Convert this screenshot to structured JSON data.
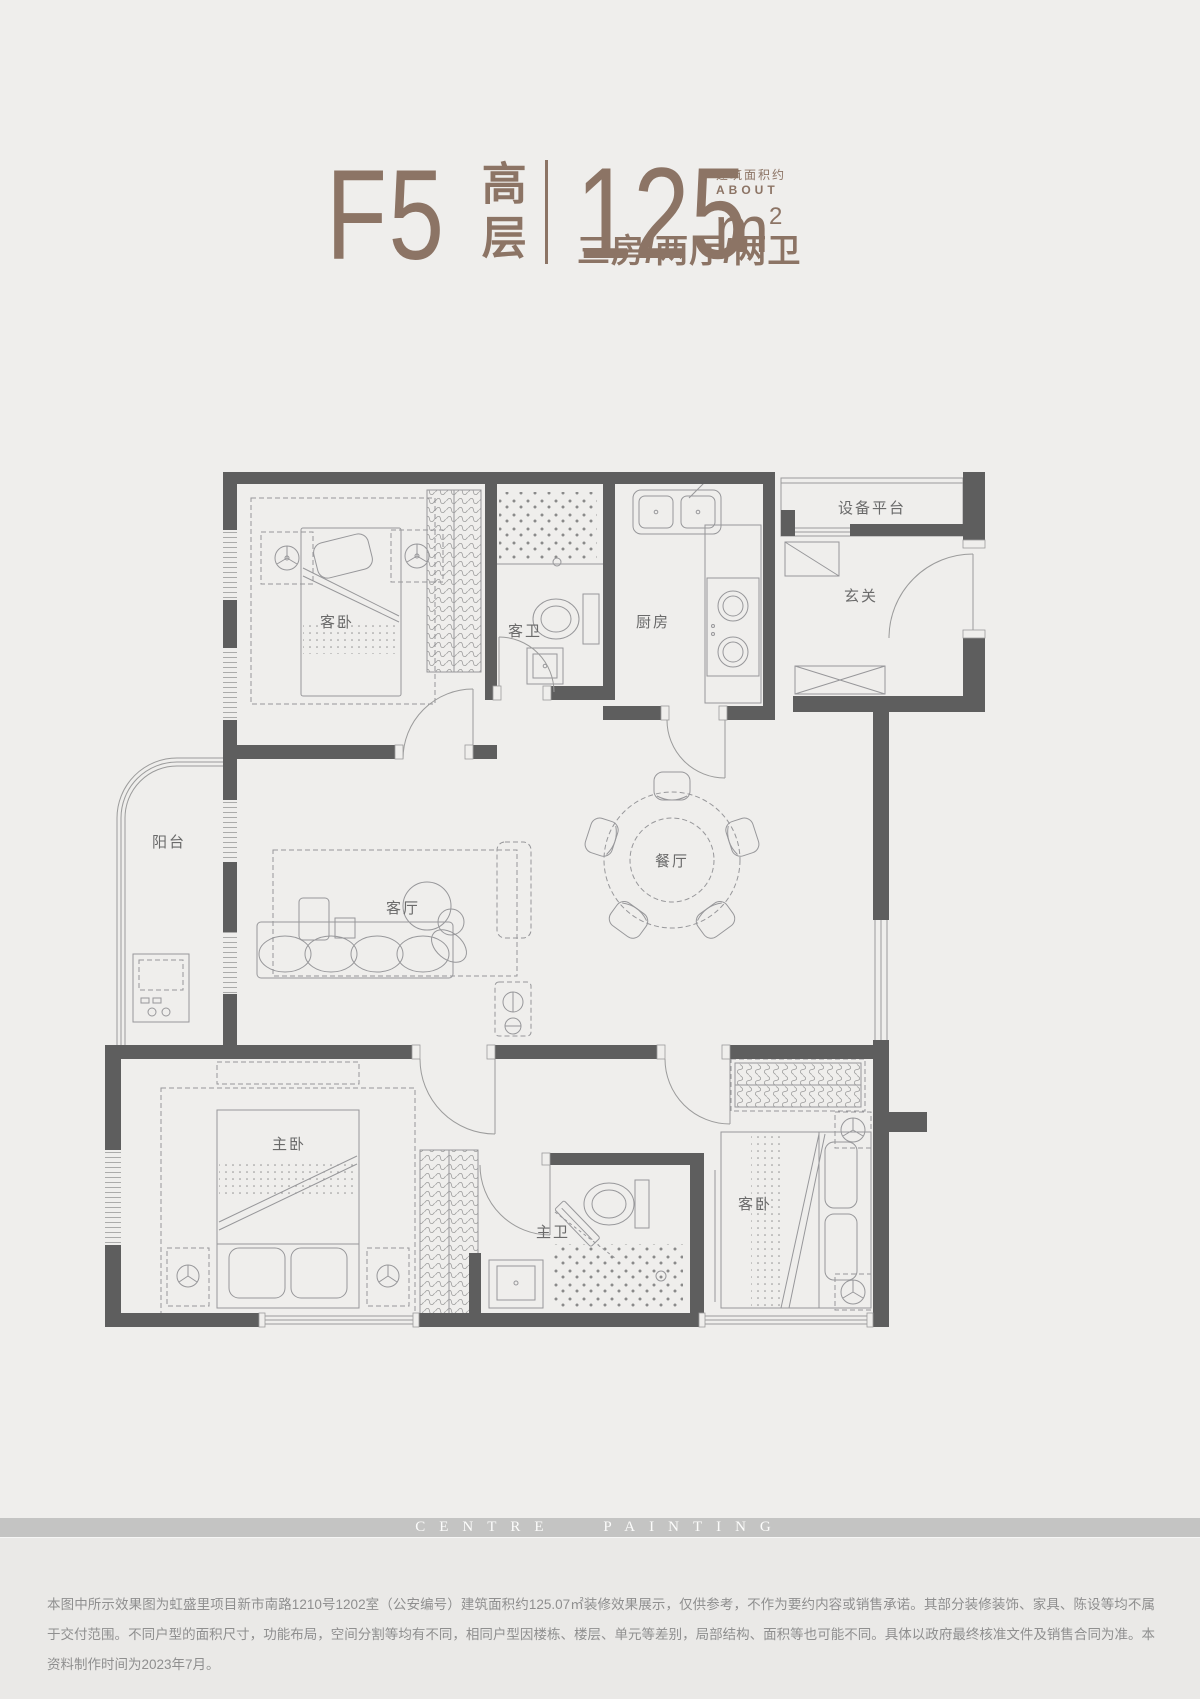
{
  "page": {
    "background": "#efeeec",
    "accent_brown": "#8c7465",
    "wall_color": "#5e5e5e",
    "line_color": "#9b9b9b"
  },
  "header": {
    "plan_code": "F5",
    "plan_type_vertical": "高层",
    "area_value": "125",
    "area_unit": "m",
    "area_sup": "2",
    "area_note_cn": "建筑面积约",
    "area_note_en": "ABOUT",
    "layout_desc": "三房/两厅/两卫"
  },
  "floorplan": {
    "labels": {
      "bedroom_top": "客卧",
      "guest_bath": "客卫",
      "kitchen": "厨房",
      "equipment_platform": "设备平台",
      "foyer": "玄关",
      "balcony": "阳台",
      "living_room": "客厅",
      "dining_room": "餐厅",
      "master_bedroom": "主卧",
      "master_bath": "主卫",
      "bedroom_bottom": "客卧"
    }
  },
  "watermark": {
    "band_text": "CENTRE PAINTING"
  },
  "footer": {
    "disclaimer": "本图中所示效果图为虹盛里项目新市南路1210号1202室（公安编号）建筑面积约125.07㎡装修效果展示，仅供参考，不作为要约内容或销售承诺。其部分装修装饰、家具、陈设等均不属于交付范围。不同户型的面积尺寸，功能布局，空间分割等均有不同，相同户型因楼栋、楼层、单元等差别，局部结构、面积等也可能不同。具体以政府最终核准文件及销售合同为准。本资料制作时间为2023年7月。"
  }
}
